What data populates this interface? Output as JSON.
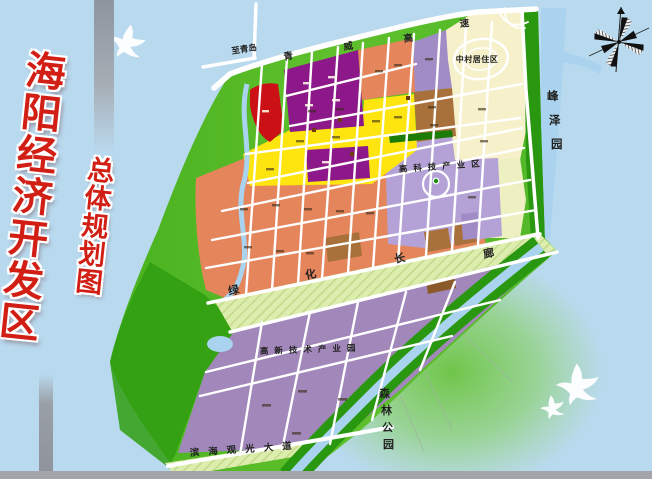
{
  "title": {
    "main": "海阳经济开发区",
    "sub": "总体规划图"
  },
  "labels": {
    "to_qingdao": "至青岛",
    "highway": [
      "青",
      "威",
      "高",
      "速"
    ],
    "zhongcun": "中村居住区",
    "fengze": [
      "峰",
      "泽",
      "园"
    ],
    "hitech_zone": "高科技产业区",
    "corridor": [
      "绿",
      "化",
      "长",
      "廊"
    ],
    "hitech_park": "高新技术产业园",
    "binhai": "滨海观光大道",
    "forest": [
      "森",
      "林",
      "公",
      "园"
    ]
  },
  "colors": {
    "sky": "#b9d9ee",
    "water": "#a9d3ee",
    "landLight": "#7ed24f",
    "landDeep": "#3fa81c",
    "forest": "#2f9d10",
    "stripGreen": "#2a9711",
    "darkGreen": "#1b7d07",
    "yellow": "#ffe50f",
    "purpleDark": "#8d188a",
    "purpleMid": "#a287bb",
    "lavender": "#b4a2d6",
    "lavenderTop": "#a18cc6",
    "salmon": "#e5855c",
    "brown": "#a8713c",
    "brownDark": "#8a5a2a",
    "cream": "#f6f1cb",
    "creamSouth": "#eef0c2",
    "red": "#cb1016",
    "band": "#dcedae",
    "bandStripe": "#c3d98a",
    "gray": "#9aa0a8",
    "strip": "#a4a4ac",
    "titleRed": "#d21f15"
  }
}
